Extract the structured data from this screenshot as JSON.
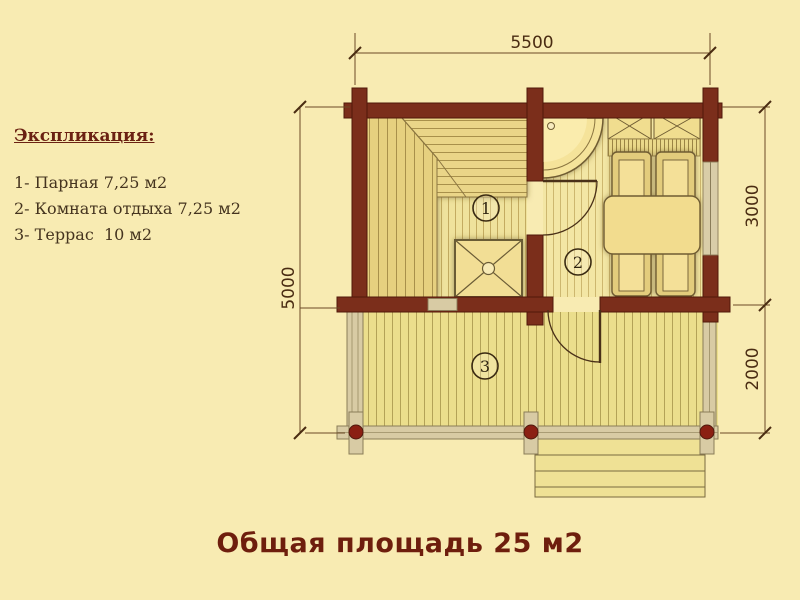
{
  "title": {
    "text": "Общая площадь 25 м2"
  },
  "legend": {
    "heading": "Экспликация:",
    "items": [
      "1- Парная 7,25 м2",
      "2- Комната отдыха 7,25 м2",
      "3- Террас  10 м2"
    ]
  },
  "dimensions": {
    "top": "5500",
    "left": "5000",
    "right_upper": "3000",
    "right_lower": "2000"
  },
  "rooms": [
    {
      "number": "1"
    },
    {
      "number": "2"
    },
    {
      "number": "3"
    }
  ],
  "colors": {
    "background": "#F8EBB2",
    "log_wall": "#7B2E1B",
    "floor_wood": "#EFE29C",
    "terrace_wood": "#EBDE8C",
    "railing": "#D8CBA4",
    "post_red": "#8B2013",
    "title_text": "#6E1E0D",
    "legend_heading_text": "#6B2112",
    "legend_item_text": "#45341F",
    "dimension_text": "#4A2C12"
  }
}
